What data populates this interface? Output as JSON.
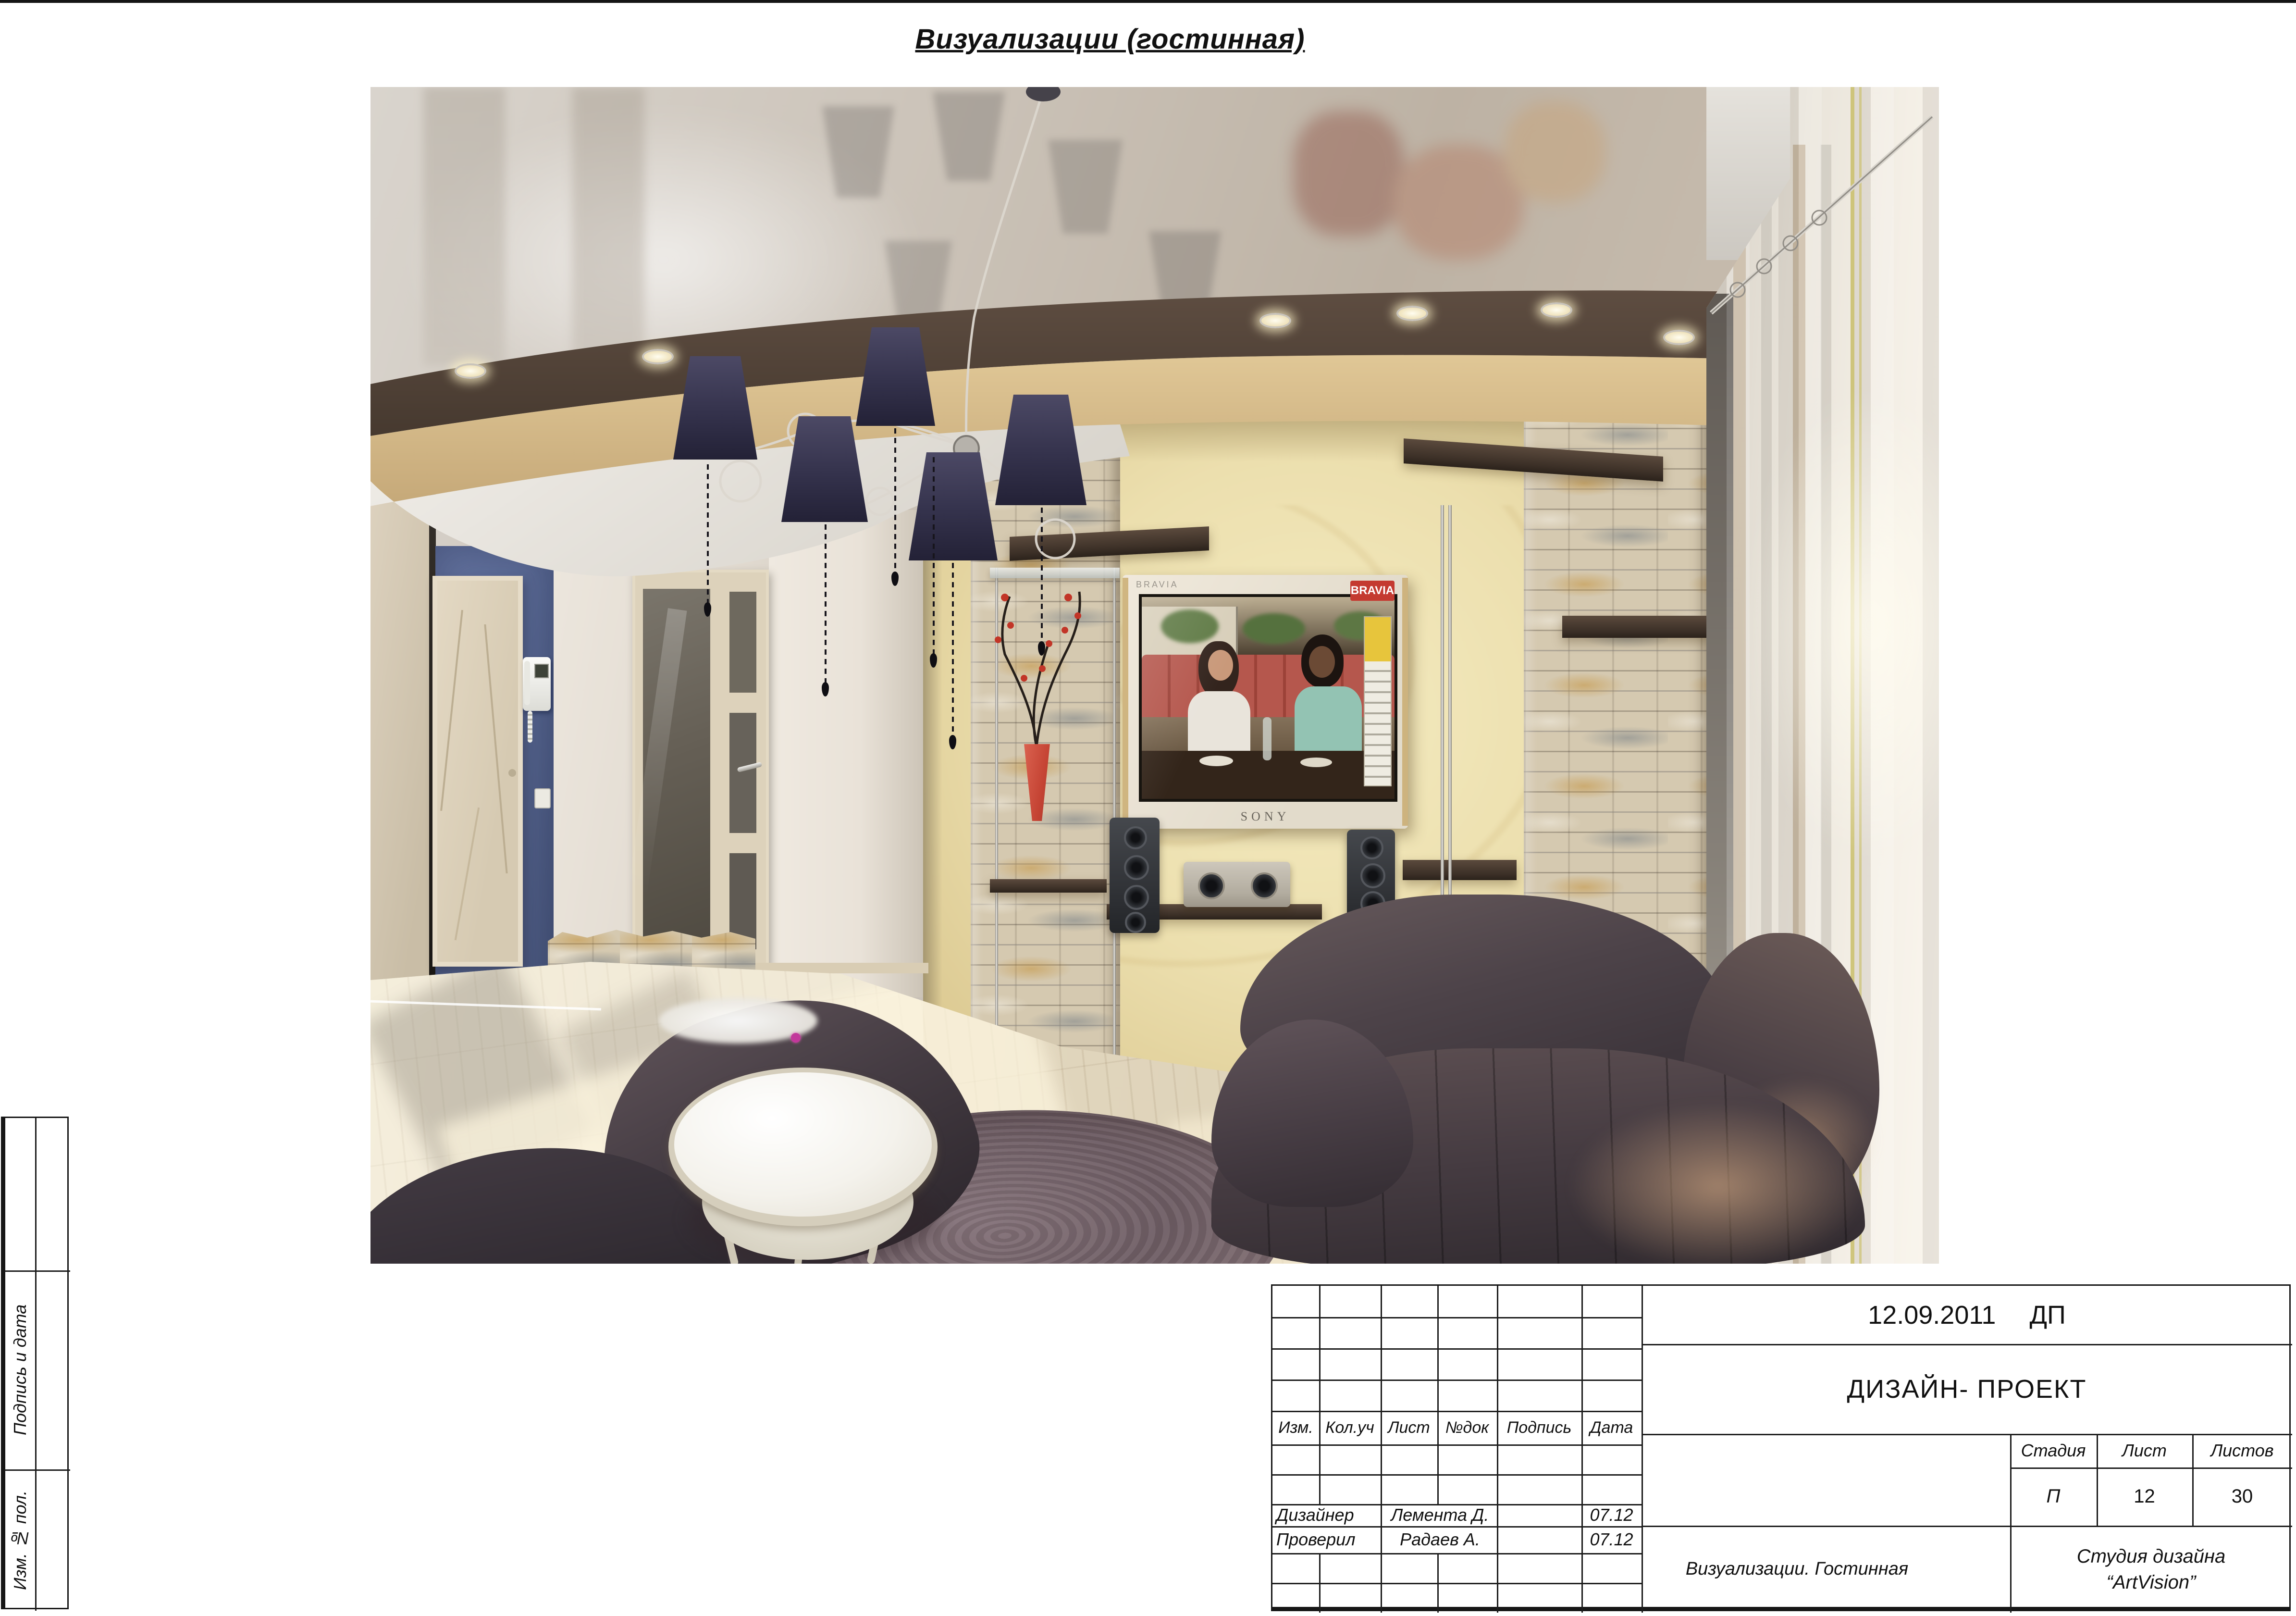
{
  "page": {
    "title": "Визуализации (гостинная)"
  },
  "render": {
    "tv": {
      "brand": "BRAVIA",
      "badge": "BRAVIA",
      "logo": "SONY"
    }
  },
  "side_strip": {
    "signature_and_date": "Подпись и дата",
    "inventory_no": "Изм. № пол."
  },
  "title_block": {
    "date": "12.09.2011",
    "doc_type": "ДП",
    "project": "ДИЗАЙН- ПРОЕКТ",
    "columns": [
      "Изм.",
      "Кол.уч",
      "Лист",
      "№док",
      "Подпись",
      "Дата"
    ],
    "signature_rows": [
      {
        "role": "Дизайнер",
        "name": "Лемента Д.",
        "date": "07.12"
      },
      {
        "role": "Проверил",
        "name": "Радаев А.",
        "date": "07.12"
      }
    ],
    "stage_label": "Стадия",
    "sheet_label": "Лист",
    "sheets_label": "Листов",
    "stage_value": "П",
    "sheet_value": "12",
    "sheets_value": "30",
    "subtitle": "Визуализации. Гостинная",
    "studio_line1": "Студия дизайна",
    "studio_line2": "“ArtVision”"
  }
}
